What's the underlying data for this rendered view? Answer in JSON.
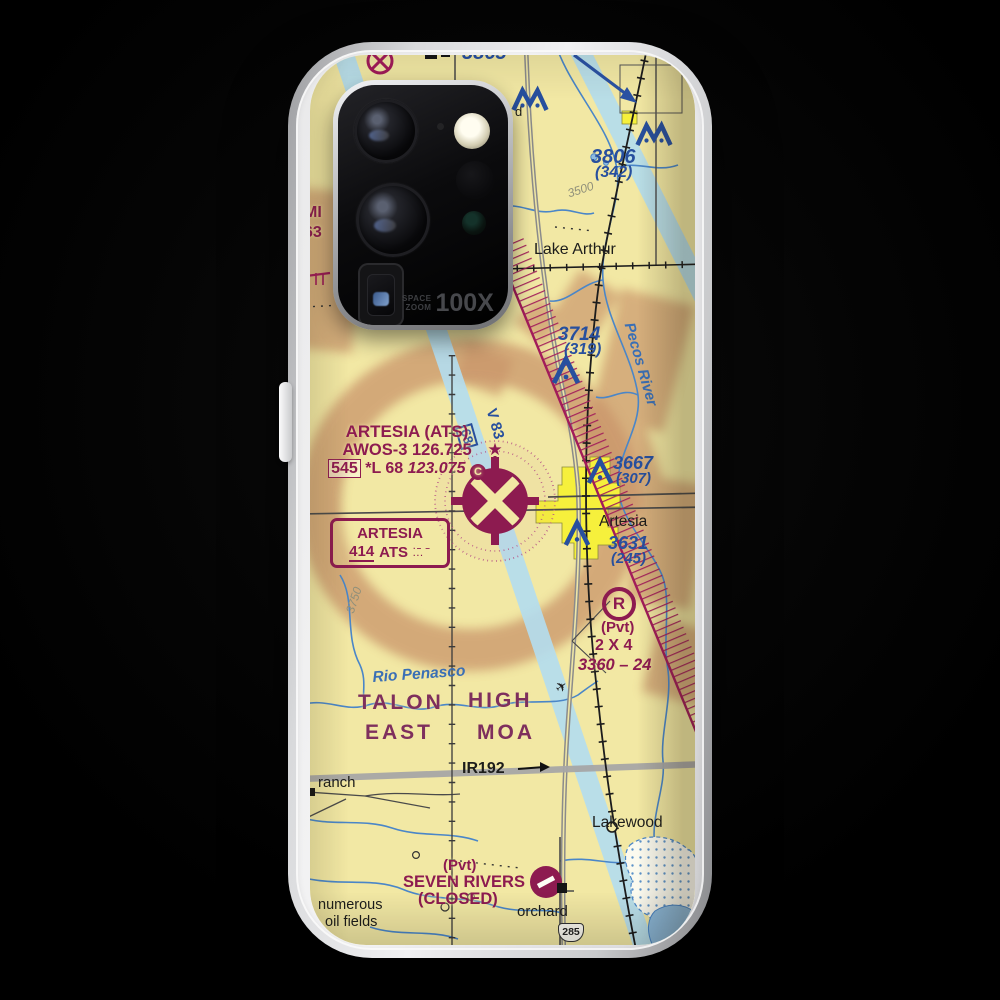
{
  "camera": {
    "line1": "SPACE",
    "line2": "ZOOM",
    "value": "100X"
  },
  "icons": {
    "airplane": "✈",
    "beacon_star": "★"
  },
  "colors": {
    "map_cream": "#f2e8a4",
    "aero_blue": "#274f9e",
    "aero_magenta": "#8d1b50",
    "terrain_brown": "#c9946b",
    "city_yellow": "#f6f03c",
    "airway_blue": "#b3ddef"
  },
  "map": {
    "labels": {
      "o3865": "3865",
      "o3806": "3806",
      "o3806agl": "(342)",
      "o3714": "3714",
      "o3714agl": "(319)",
      "o3667": "3667",
      "o3667agl": "(307)",
      "o3631": "3631",
      "o3631agl": "(245)",
      "lake_arthur": "Lake Arthur",
      "c3500": "3500",
      "c3750": "3750",
      "pecos_river": "Pecos River",
      "rio_penasco": "Rio Penasco",
      "v83": "V 83",
      "v83_box": "68",
      "info1": "ARTESIA (ATS)",
      "info2": "AWOS-3 126.725",
      "info_elev": "545",
      "info_suffix": "*L 68",
      "info_ctaf": "123.075",
      "info_c": "C",
      "ndb_name": "ARTESIA",
      "ndb_freq": "414",
      "ndb_id": "ATS",
      "morse1": "·– –",
      "morse2": "···",
      "artesia": "Artesia",
      "r_symbol": "R",
      "pvt": "(Pvt)",
      "pvt_name": "2 X 4",
      "pvt_data": "3360 – 24",
      "moa_talon": "TALON",
      "moa_east": "EAST",
      "moa_high": "HIGH",
      "moa_moa": "MOA",
      "ir192": "IR192",
      "ranch": "ranch",
      "lakewood": "Lakewood",
      "sr_pvt": "(Pvt)",
      "sr_name": "SEVEN RIVERS",
      "sr_closed": "(CLOSED)",
      "orchard": "orchard",
      "shield_285": "285",
      "oil1": "numerous",
      "oil2": "oil fields",
      "edge_mi": "MI",
      "edge_63": "63",
      "partial_d": "d"
    }
  }
}
